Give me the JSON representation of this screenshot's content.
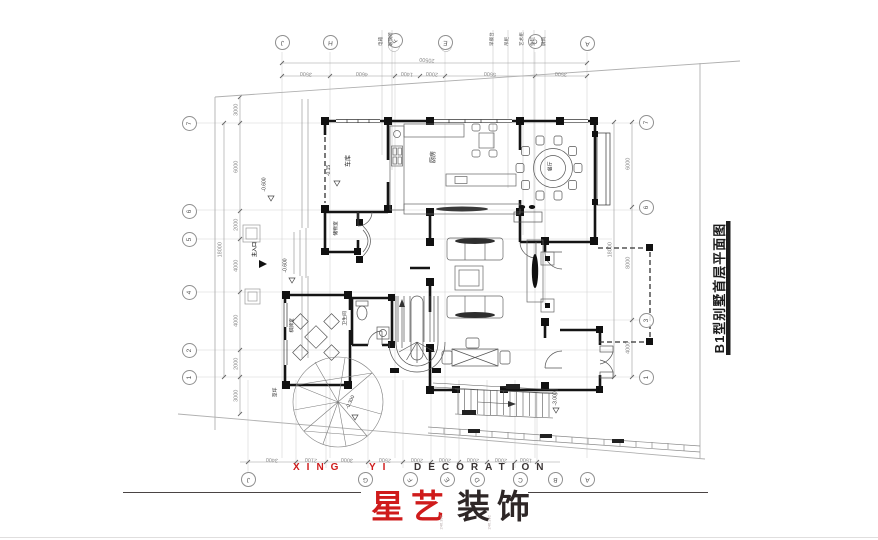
{
  "brand": {
    "latin_xing": "XING",
    "latin_yi": "YI",
    "latin_deco": "DECORATION",
    "cn_red": "星艺",
    "cn_dark": "装饰",
    "red": "#cf1b1b",
    "dark": "#332b2b"
  },
  "title_block": {
    "text": "B1型别墅首层平面图"
  },
  "grid": {
    "top": {
      "bubbles": [
        "J",
        "H",
        "F",
        "E",
        "C",
        "A"
      ],
      "dims": [
        "3500",
        "4600",
        "1400",
        "2000",
        "5500",
        "3500"
      ],
      "overall": "20500"
    },
    "bottom": {
      "bubbles": [
        "J",
        "G",
        "F",
        "E",
        "D",
        "C",
        "B",
        "A"
      ],
      "dims": [
        "3400",
        "2100",
        "3000",
        "2500",
        "2000",
        "2000",
        "2000",
        "2000",
        "1500"
      ]
    },
    "left": {
      "bubbles": [
        "7",
        "6",
        "5",
        "4",
        "2",
        "1"
      ],
      "dims": [
        "3000",
        "6000",
        "2000",
        "4000",
        "4000",
        "2000",
        "3000"
      ],
      "overall": "18000"
    },
    "right": {
      "bubbles": [
        "7",
        "6",
        "3",
        "1"
      ],
      "dims": [
        "6000",
        "8000",
        "4000"
      ],
      "overall": "18000"
    }
  },
  "rooms": {
    "garage": "车库",
    "kitchen": "厨房",
    "dining": "餐厅",
    "storage": "储物室",
    "mahjong": "棋牌室",
    "bath": "卫生间",
    "lawn": "草坪"
  },
  "levels": {
    "driveway": "-0.600",
    "garage": "-0.15",
    "entry": "-0.600",
    "lawn": "-0.300",
    "terrace": "-3.000"
  },
  "entrance": {
    "label": "主入口"
  },
  "callouts": [
    "电箱",
    "玻璃砖",
    "早餐台",
    "吊柜",
    "艺术柜",
    "鱼缸",
    "屏风"
  ],
  "survey_marks": [
    "246.392",
    "246.392"
  ]
}
